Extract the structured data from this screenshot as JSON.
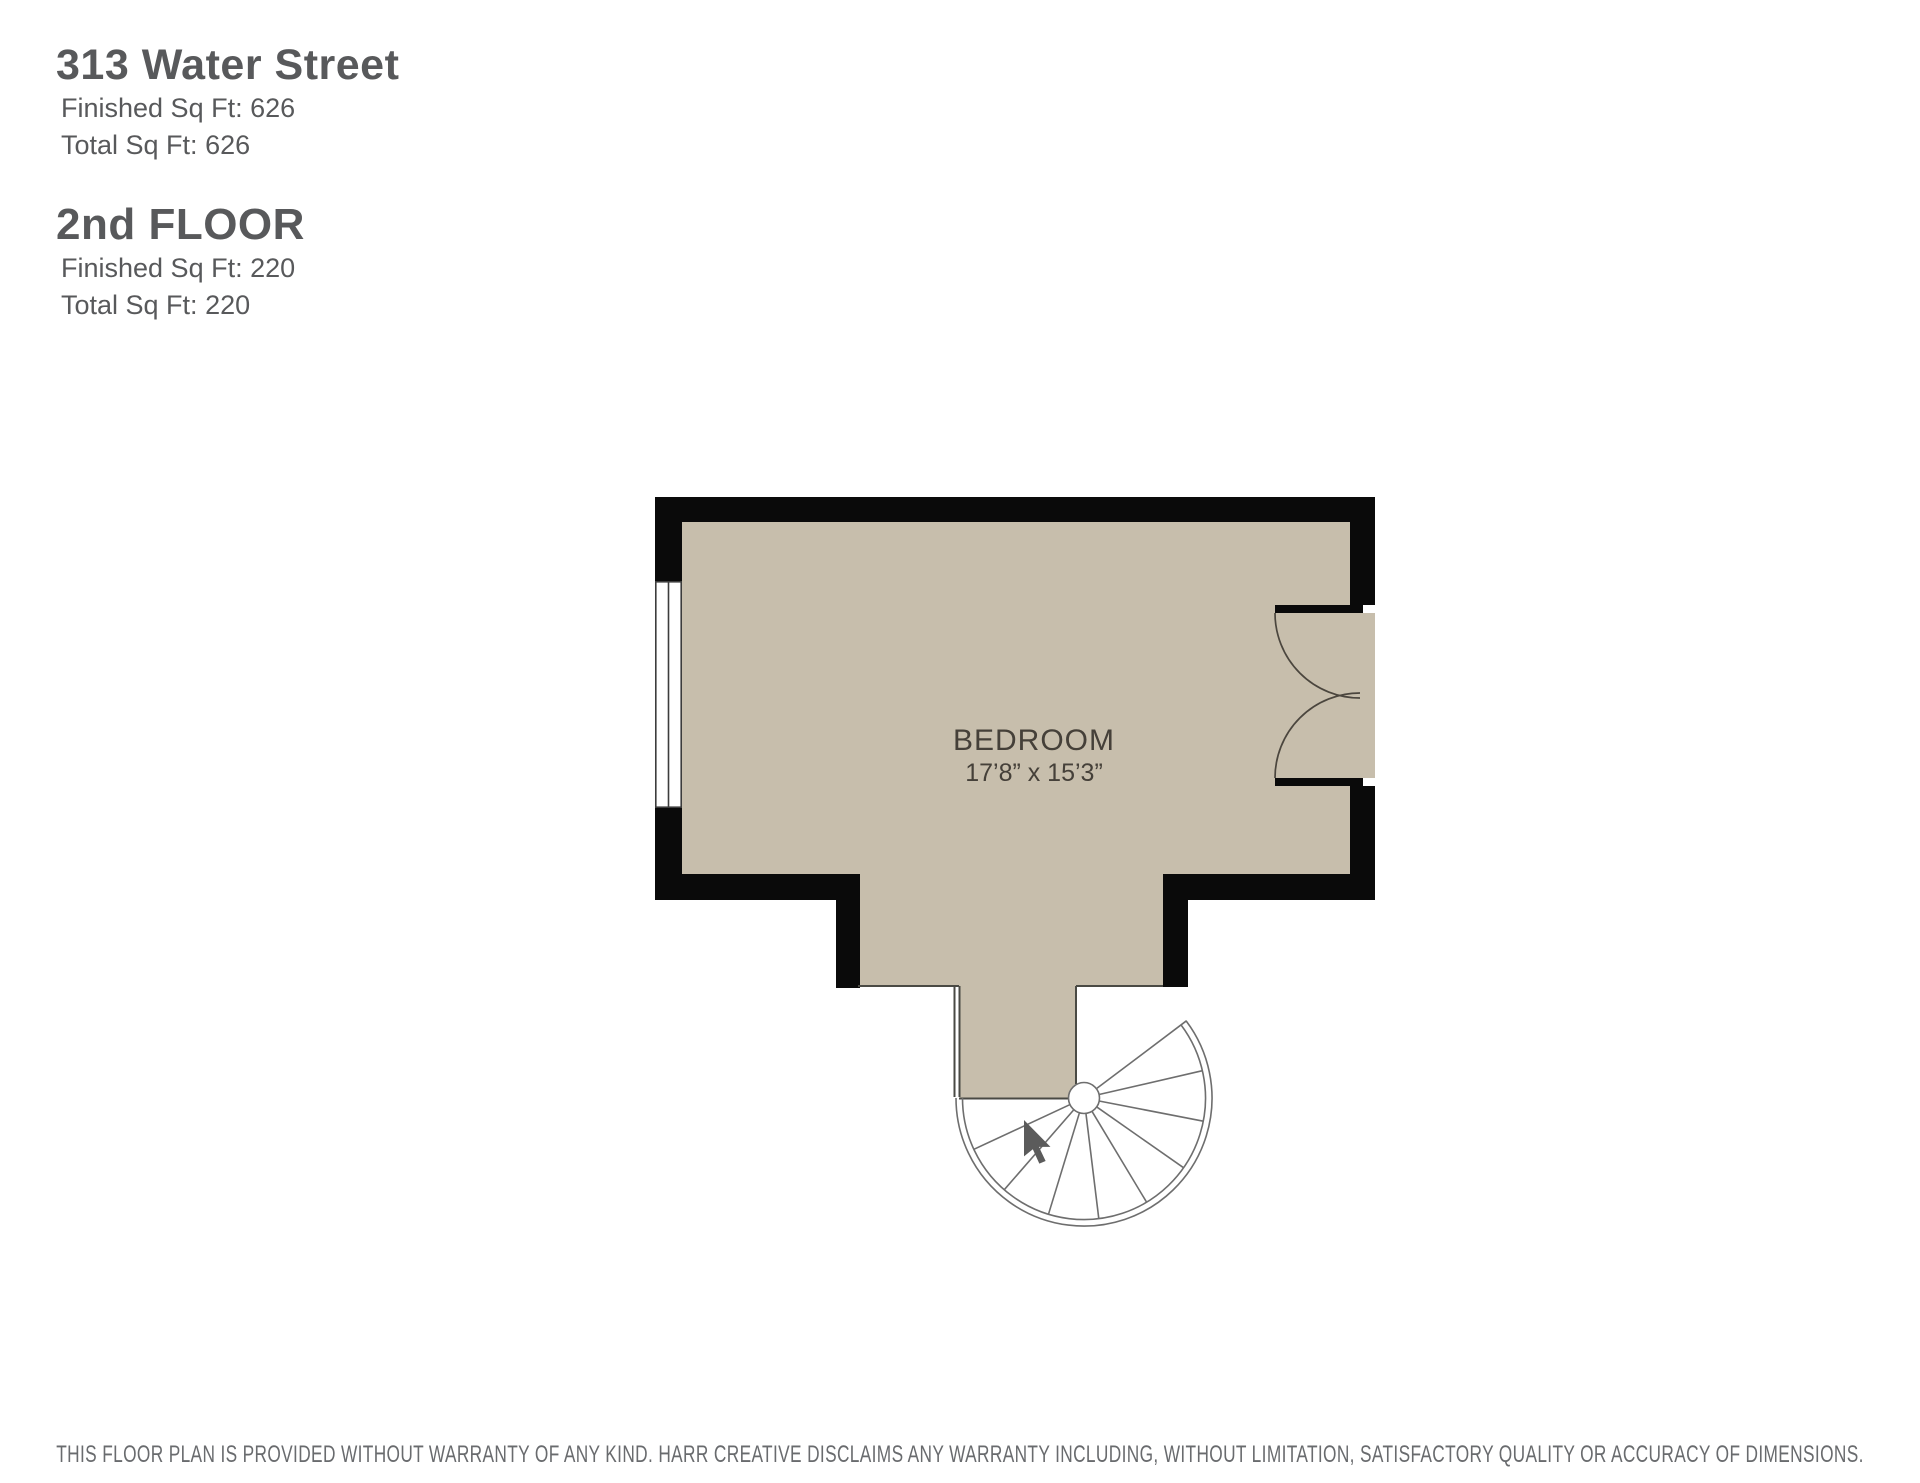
{
  "header": {
    "building_name": "313 Water Street",
    "finished_label": "Finished Sq Ft:",
    "building_finished_value": "626",
    "total_label": "Total Sq Ft:",
    "building_total_value": "626",
    "floor_name": "2nd FLOOR",
    "floor_finished_value": "220",
    "floor_total_value": "220"
  },
  "plan": {
    "room": {
      "name": "BEDROOM",
      "dimensions": "17’8” x 15’3”"
    },
    "features": [
      "window-left-wall",
      "double-door-right-wall",
      "spiral-staircase-bottom",
      "stair-direction-arrow"
    ],
    "colors": {
      "floor_fill": "#c7beac",
      "wall": "#0a0a0a",
      "thin_line": "#4a4a44",
      "stair_line": "#6e6e6e",
      "arrow": "#5b5b5b"
    }
  },
  "footer": {
    "disclaimer": "THIS FLOOR PLAN IS PROVIDED WITHOUT WARRANTY OF ANY KIND. HARR CREATIVE DISCLAIMS ANY WARRANTY INCLUDING, WITHOUT LIMITATION, SATISFACTORY QUALITY OR ACCURACY OF DIMENSIONS."
  }
}
